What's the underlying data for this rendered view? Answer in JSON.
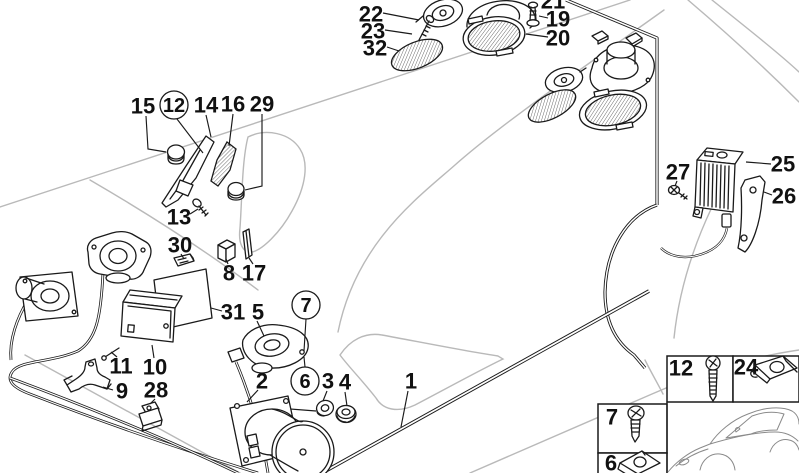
{
  "meta": {
    "background_color": "#ffffff",
    "ink_color": "#1a1a1a",
    "car_outline_color": "#b9b9b9",
    "diagram_type": "exploded parts diagram"
  },
  "labels": {
    "p1": "1",
    "p2": "2",
    "p3": "3",
    "p4": "4",
    "p5": "5",
    "p8": "8",
    "p9": "9",
    "p10": "10",
    "p11": "11",
    "p13": "13",
    "p14": "14",
    "p15": "15",
    "p16": "16",
    "p17": "17",
    "p19": "19",
    "p20": "20",
    "p21": "21",
    "p22": "22",
    "p23": "23",
    "p25": "25",
    "p26": "26",
    "p27": "27",
    "p28": "28",
    "p29": "29",
    "p30": "30",
    "p31": "31",
    "p32": "32",
    "circled6": "6",
    "circled7": "7",
    "circled12": "12"
  },
  "inset": {
    "screw_long_label": "12",
    "speed_nut_large_label": "24",
    "screw_short_label": "7",
    "speed_nut_small_label": "6"
  }
}
